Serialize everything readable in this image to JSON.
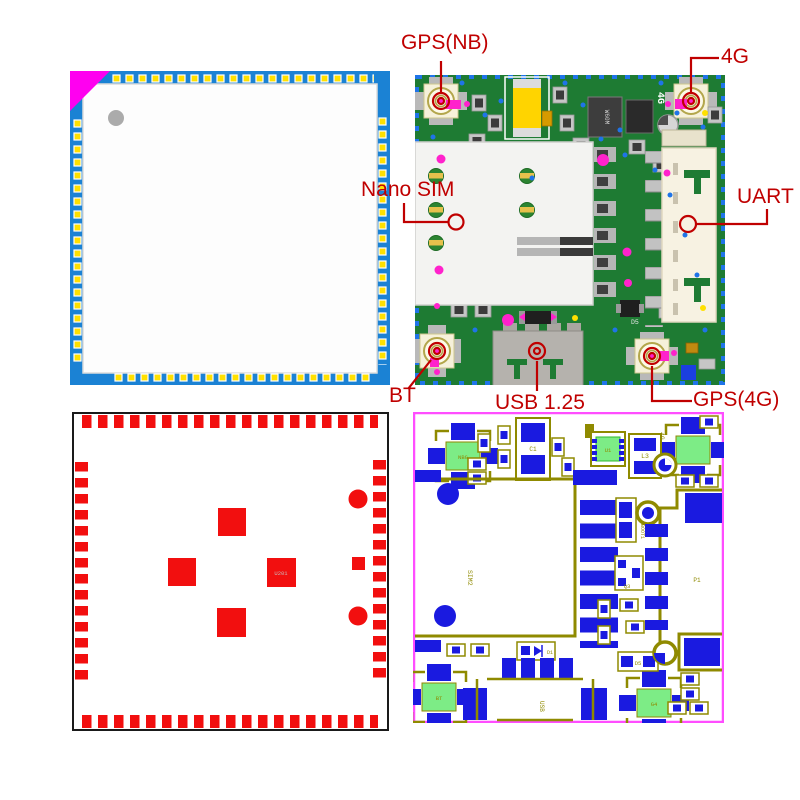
{
  "annotations": {
    "color": "#c00000",
    "gps_nb": "GPS(NB)",
    "four_g": "4G",
    "nano_sim": "Nano SIM",
    "uart": "UART",
    "bt": "BT",
    "usb": "USB 1.25",
    "gps_4g": "GPS(4G)"
  },
  "pcb_top_view": {
    "silk_4g": "4G",
    "ic_label": "W60M",
    "silk_d5": "D5"
  },
  "footprint_view": {
    "ref_u201": "U201"
  },
  "layout_view": {
    "refs": {
      "nbg": "NBG",
      "c1": "C1",
      "u1": "U1",
      "l3": "L3",
      "four_g": "4G",
      "sim2": "SIM2",
      "boot1": "BOOT1",
      "p1": "P1",
      "q3": "Q3",
      "d5": "D5",
      "d1": "D1",
      "usb": "USB",
      "bt": "BT",
      "g4": "G4"
    }
  },
  "colors": {
    "annotation_red": "#c00000",
    "module_blue": "#1b82d4",
    "pad_yellow": "#ffe000",
    "corner_magenta": "#ff00f0",
    "pcb_green": "#1e7b33",
    "via_blue": "#1f74e8",
    "connector_ivory": "#f6f1da",
    "footprint_red": "#f20f0f",
    "layout_blue": "#1a1ae0",
    "layout_olive": "#8f8a00",
    "layout_green": "#7dec86",
    "layout_border_magenta": "#ff4dff"
  }
}
